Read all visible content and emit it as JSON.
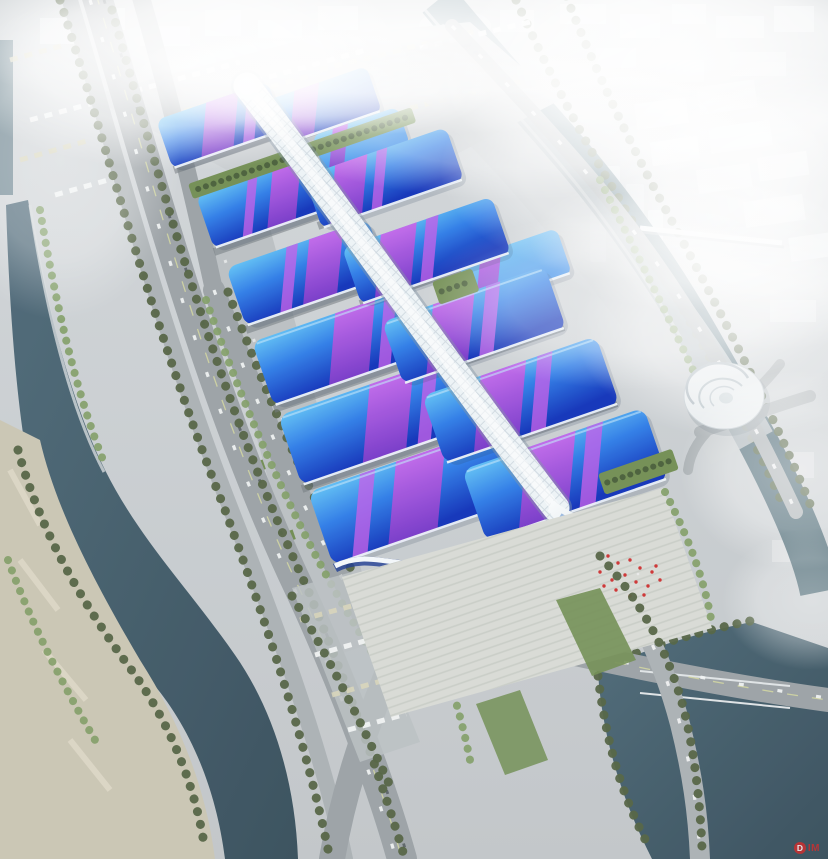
{
  "watermark": {
    "badge": "D",
    "text": "IM"
  },
  "palette": {
    "ground": "#c6cbcf",
    "yard": "#c9cdd0",
    "apron": "#b9bec1",
    "roadDark": "#99a0a4",
    "roadLight": "#a9afb3",
    "laneYellow": "#d6da9e",
    "carWhite": "#f2f4f4",
    "carDark": "#4a5156",
    "cityBlock": "#e7eaec",
    "treeDark": "#50603f",
    "treeLight": "#7d9b62",
    "lawn": "#6f8c50",
    "parkTan": "#c9c4b2",
    "plaza": "#d7dad4",
    "quay": "#d2d7d9",
    "waterDark": "#334b58",
    "waterMid": "#557585",
    "spineWhite": "#edf3f6",
    "spineShadow": "#7e93a2",
    "roofBlueLight": "#55b8f2",
    "roofBlueMid": "#2271e2",
    "roofBlueDeep": "#0c2fb8",
    "purple": "#8a3ad0",
    "magenta": "#c35ae8",
    "fasciaBlue": "#16368e",
    "accentRed": "#cc2f2f",
    "dock": "#70777c"
  },
  "scene": {
    "subject": "Aerial rendering of a large exhibition and convention center",
    "features": {
      "hall_roofs": "blue gradient roofs with purple ribbon bands",
      "central_spine": "white latticed corridor running the length of the complex",
      "south_end": "wave-shaped entrance canopy with shell-like tip and striped plaza",
      "surroundings": "rivers and canals, tree-lined roads, truck marshalling yard, foggy city skyline",
      "landmark": "spiral terraced building near the southeast canal"
    },
    "counts": {
      "west_halls": 6,
      "east_halls": 8,
      "green_roof_terraces": 3
    }
  }
}
